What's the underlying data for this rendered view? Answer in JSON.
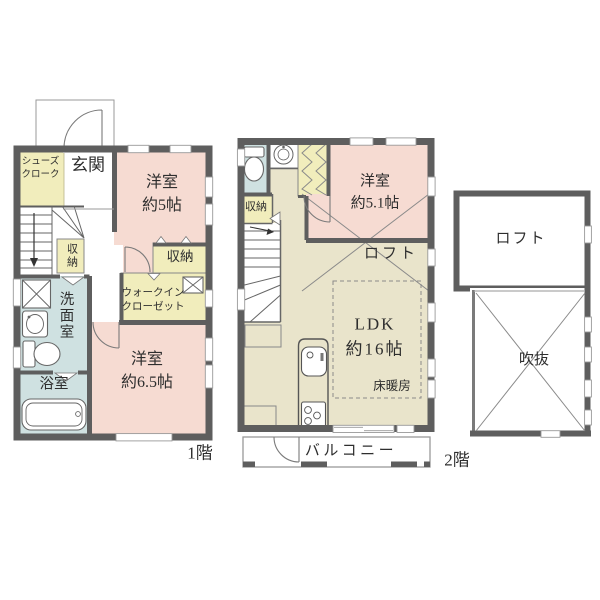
{
  "title": "間取り図",
  "palette": {
    "wall": "#5e5e5e",
    "room_pink": "#f6dbd2",
    "closet_yellow": "#f1edbc",
    "water_blue": "#cfe1e1",
    "living_beige": "#e9e4cb",
    "background": "#ffffff"
  },
  "floor1": {
    "label": "1階",
    "rooms": {
      "shoe_cloak": "シューズ\nクローク",
      "entrance": "玄関",
      "bedroom_5": "洋室\n約5帖",
      "stair_closet": "収納",
      "bedroom5_closet": "収納",
      "walk_in_closet": "ウォークイン\nクローゼット",
      "washroom": "洗面室",
      "bath": "浴室",
      "bedroom_65": "洋室\n約6.5帖"
    }
  },
  "floor2": {
    "label": "2階",
    "rooms": {
      "closet": "収納",
      "bedroom_51": "洋室\n約5.1帖",
      "loft": "ロフト",
      "ldk": "LDK\n約16帖",
      "floor_heating": "床暖房",
      "balcony": "バルコニー"
    }
  },
  "loft_floor": {
    "rooms": {
      "loft": "ロフト",
      "void": "吹抜"
    }
  }
}
